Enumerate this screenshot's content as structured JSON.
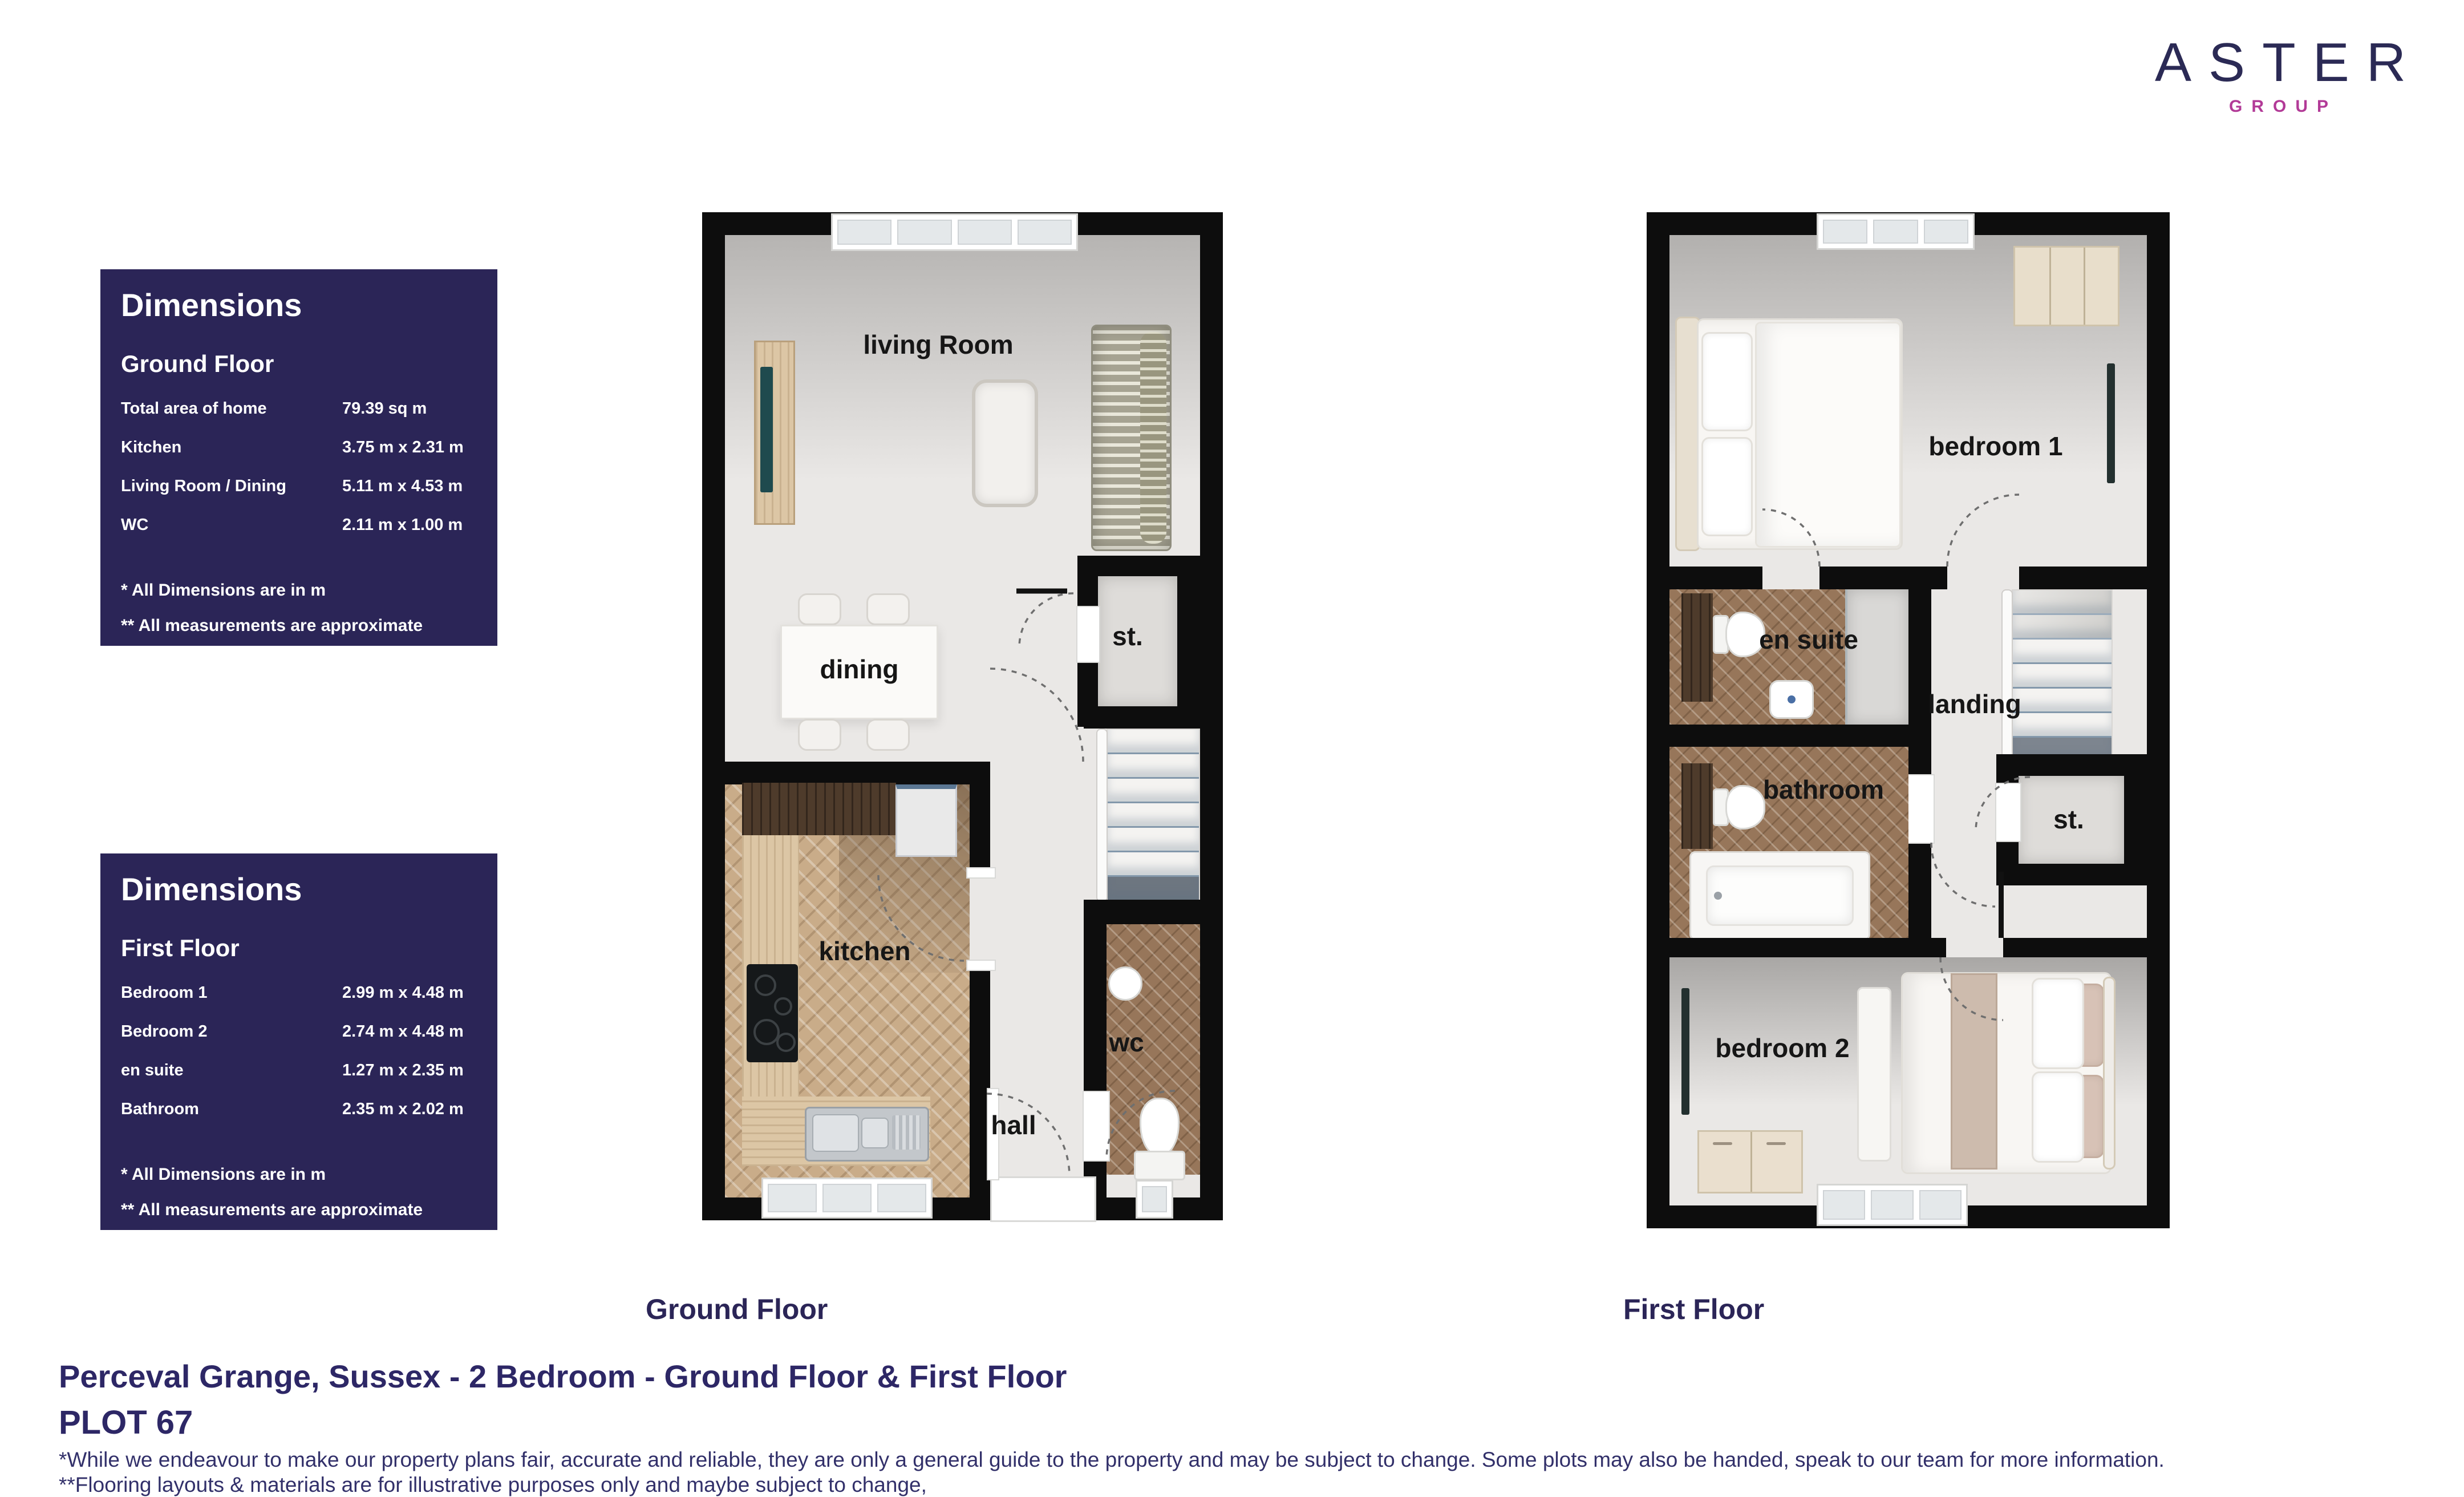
{
  "logo": {
    "name": "ASTER",
    "group": "GROUP"
  },
  "colors": {
    "navy_panel": "#2b2557",
    "navy_text": "#2d2766",
    "magenta": "#b23a97",
    "wall_black": "#0d0d0d",
    "floor_light": "#eae8e6",
    "wood_light": "#c9ac89",
    "wood_dark": "#97765a"
  },
  "dimensions_boxes": [
    {
      "title": "Dimensions",
      "floor": "Ground Floor",
      "rows": [
        {
          "label": "Total area of home",
          "value": "79.39  sq m"
        },
        {
          "label": "Kitchen",
          "value": "3.75 m x 2.31 m"
        },
        {
          "label": "Living Room / Dining",
          "value": "5.11 m x 4.53 m"
        },
        {
          "label": "WC",
          "value": "2.11 m x 1.00 m"
        }
      ],
      "notes": [
        "* All Dimensions are in m",
        "** All measurements are approximate"
      ]
    },
    {
      "title": "Dimensions",
      "floor": "First Floor",
      "rows": [
        {
          "label": "Bedroom 1",
          "value": "2.99 m x 4.48 m"
        },
        {
          "label": "Bedroom 2",
          "value": "2.74 m x 4.48 m"
        },
        {
          "label": "en suite",
          "value": "1.27 m x 2.35 m"
        },
        {
          "label": "Bathroom",
          "value": "2.35 m x 2.02 m"
        }
      ],
      "notes": [
        "* All Dimensions are in m",
        "** All measurements are approximate"
      ]
    }
  ],
  "plans": {
    "ground": {
      "caption": "Ground Floor",
      "rooms": {
        "living": "living Room",
        "dining": "dining",
        "storage": "st.",
        "kitchen": "kitchen",
        "hall": "hall",
        "wc": "wc"
      }
    },
    "first": {
      "caption": "First Floor",
      "rooms": {
        "bedroom1": "bedroom 1",
        "ensuite": "en suite",
        "landing": "landing",
        "bathroom": "bathroom",
        "storage": "st.",
        "bedroom2": "bedroom 2"
      }
    }
  },
  "footer": {
    "title": "Perceval Grange, Sussex - 2 Bedroom  - Ground Floor & First Floor",
    "plot": "PLOT 67",
    "disclaimer1": "*While we endeavour to make our property plans fair, accurate and reliable, they are only a general guide to the property and may be subject to change. Some plots may also be handed, speak to our team for more information.",
    "disclaimer2": "**Flooring layouts & materials are for illustrative purposes only and maybe subject to change,"
  }
}
